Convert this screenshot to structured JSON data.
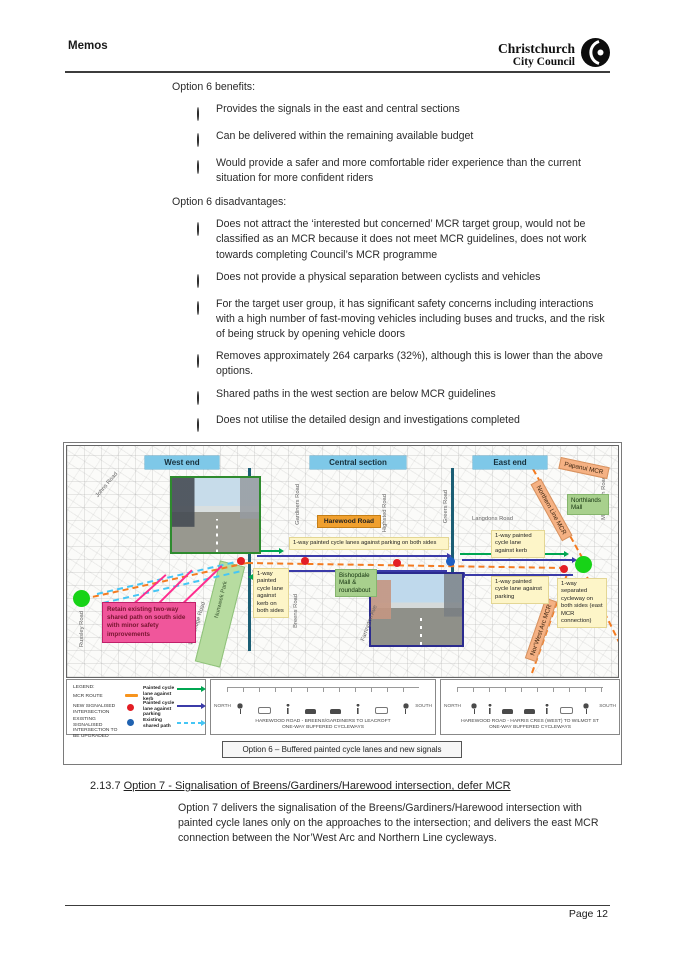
{
  "header": {
    "doc_type": "Memos",
    "logo_line1": "Christchurch",
    "logo_line2": "City Council"
  },
  "content": {
    "option6_benefits": {
      "heading": "Option 6 benefits:",
      "items": [
        "Provides the signals in the east and central sections",
        "Can be delivered within the remaining available budget",
        "Would provide a safer and more comfortable rider experience than the current situation for more confident riders"
      ]
    },
    "option6_disadvantages": {
      "heading": "Option 6 disadvantages:",
      "items": [
        "Does not attract the ‘interested but concerned’ MCR target group, would not be classified as an MCR because it does not meet MCR guidelines, does not work towards completing Council’s MCR programme",
        "Does not provide a physical separation between cyclists and vehicles",
        "For the target user group, it has significant safety concerns including interactions with a high number of fast-moving vehicles including buses and trucks, and the risk of being struck by opening vehicle doors",
        "Removes approximately 264 carparks (32%), although this is lower than the above options.",
        "Shared paths in the west section are below MCR guidelines",
        "Does not utilise the detailed design and investigations completed",
        "Full community consultation and a new decision report would be required"
      ]
    },
    "section_2_13_7": {
      "number": "2.13.7",
      "title": "Option 7 - Signalisation of Breens/Gardiners/Harewood intersection, defer MCR",
      "bullet": "Option 7 delivers the signalisation of the Breens/Gardiners/Harewood intersection with painted cycle lanes only on the approaches to the intersection; and delivers the east MCR connection between the Nor’West Arc and Northern Line cycleways."
    }
  },
  "figure": {
    "section_labels": {
      "west": "West end",
      "central": "Central section",
      "east": "East end"
    },
    "road_labels": {
      "johns": "Johns Road",
      "russley": "Russley Road",
      "wooldridge": "Wooldridge Road",
      "nunweek": "Nunweek Park",
      "gardiners": "Gardiners Road",
      "breens": "Breens Road",
      "highsted": "Highsted Road",
      "farrington": "Farrington Ave",
      "greers": "Greers Road",
      "langdons": "Langdons Road",
      "main_north": "Main North Road"
    },
    "place_labels": {
      "harewood_road": "Harewood Road",
      "bishopdale": "Bishopdale Mall & roundabout",
      "northlands": "Northlands Mall",
      "papanui_mcr": "Papanui MCR",
      "northern_line_mcr": "Northern Line MCR",
      "norwest_arc_mcr": "Nor’West Arc MCR"
    },
    "callouts": {
      "parking_both": "1-way painted cycle lanes against parking on both sides",
      "kerb_both": "1-way painted cycle lane against kerb on both sides",
      "kerb_east": "1-way painted cycle lane against kerb",
      "parking_east": "1-way painted cycle lane against parking",
      "separated_east": "1-way separated cycleway on both sides (east MCR connection)",
      "retain_path": "Retain existing two-way shared path on south side with minor safety improvements"
    },
    "legend": {
      "title": "LEGEND:",
      "mcr_route": "MCR ROUTE",
      "new_signalised": "NEW SIGNALISED INTERSECTION",
      "existing_signalised": "EXISTING SIGNALISED INTERSECTION TO BE UPGRADED",
      "painted_kerb": "Painted cycle lane against kerb",
      "painted_parking": "Painted cycle lane against parking",
      "shared_path": "Existing shared path"
    },
    "cross_sections": [
      {
        "left_label": "NORTH",
        "right_label": "SOUTH",
        "line1": "HAREWOOD ROAD - BREENS/GARDINERS TO LEACROFT",
        "line2": "ONE-WAY BUFFERED CYCLEWAYS"
      },
      {
        "left_label": "NORTH",
        "right_label": "SOUTH",
        "line1": "HAREWOOD ROAD - HARRIS CRES (WEST) TO WILMOT ST",
        "line2": "ONE-WAY BUFFERED CYCLEWAYS"
      }
    ],
    "caption": "Option 6 – Buffered painted cycle lanes and new signals"
  },
  "footer": {
    "page": "Page 12"
  },
  "colors": {
    "section_header_blue": "#7ec8e8",
    "callout_yellow": "#fdf5c8",
    "mall_green": "#a8d08d",
    "mcr_orange": "#f5b183",
    "harewood_orange": "#f0a02f",
    "retain_pink": "#f0569b",
    "mcr_route_orange": "#f47b20",
    "painted_kerb_green": "#00a651",
    "painted_parking_purple": "#3b3ba8",
    "shared_path_cyan": "#45c6f5",
    "new_signal_red": "#e31e24",
    "existing_signal_blue": "#2062b0"
  }
}
